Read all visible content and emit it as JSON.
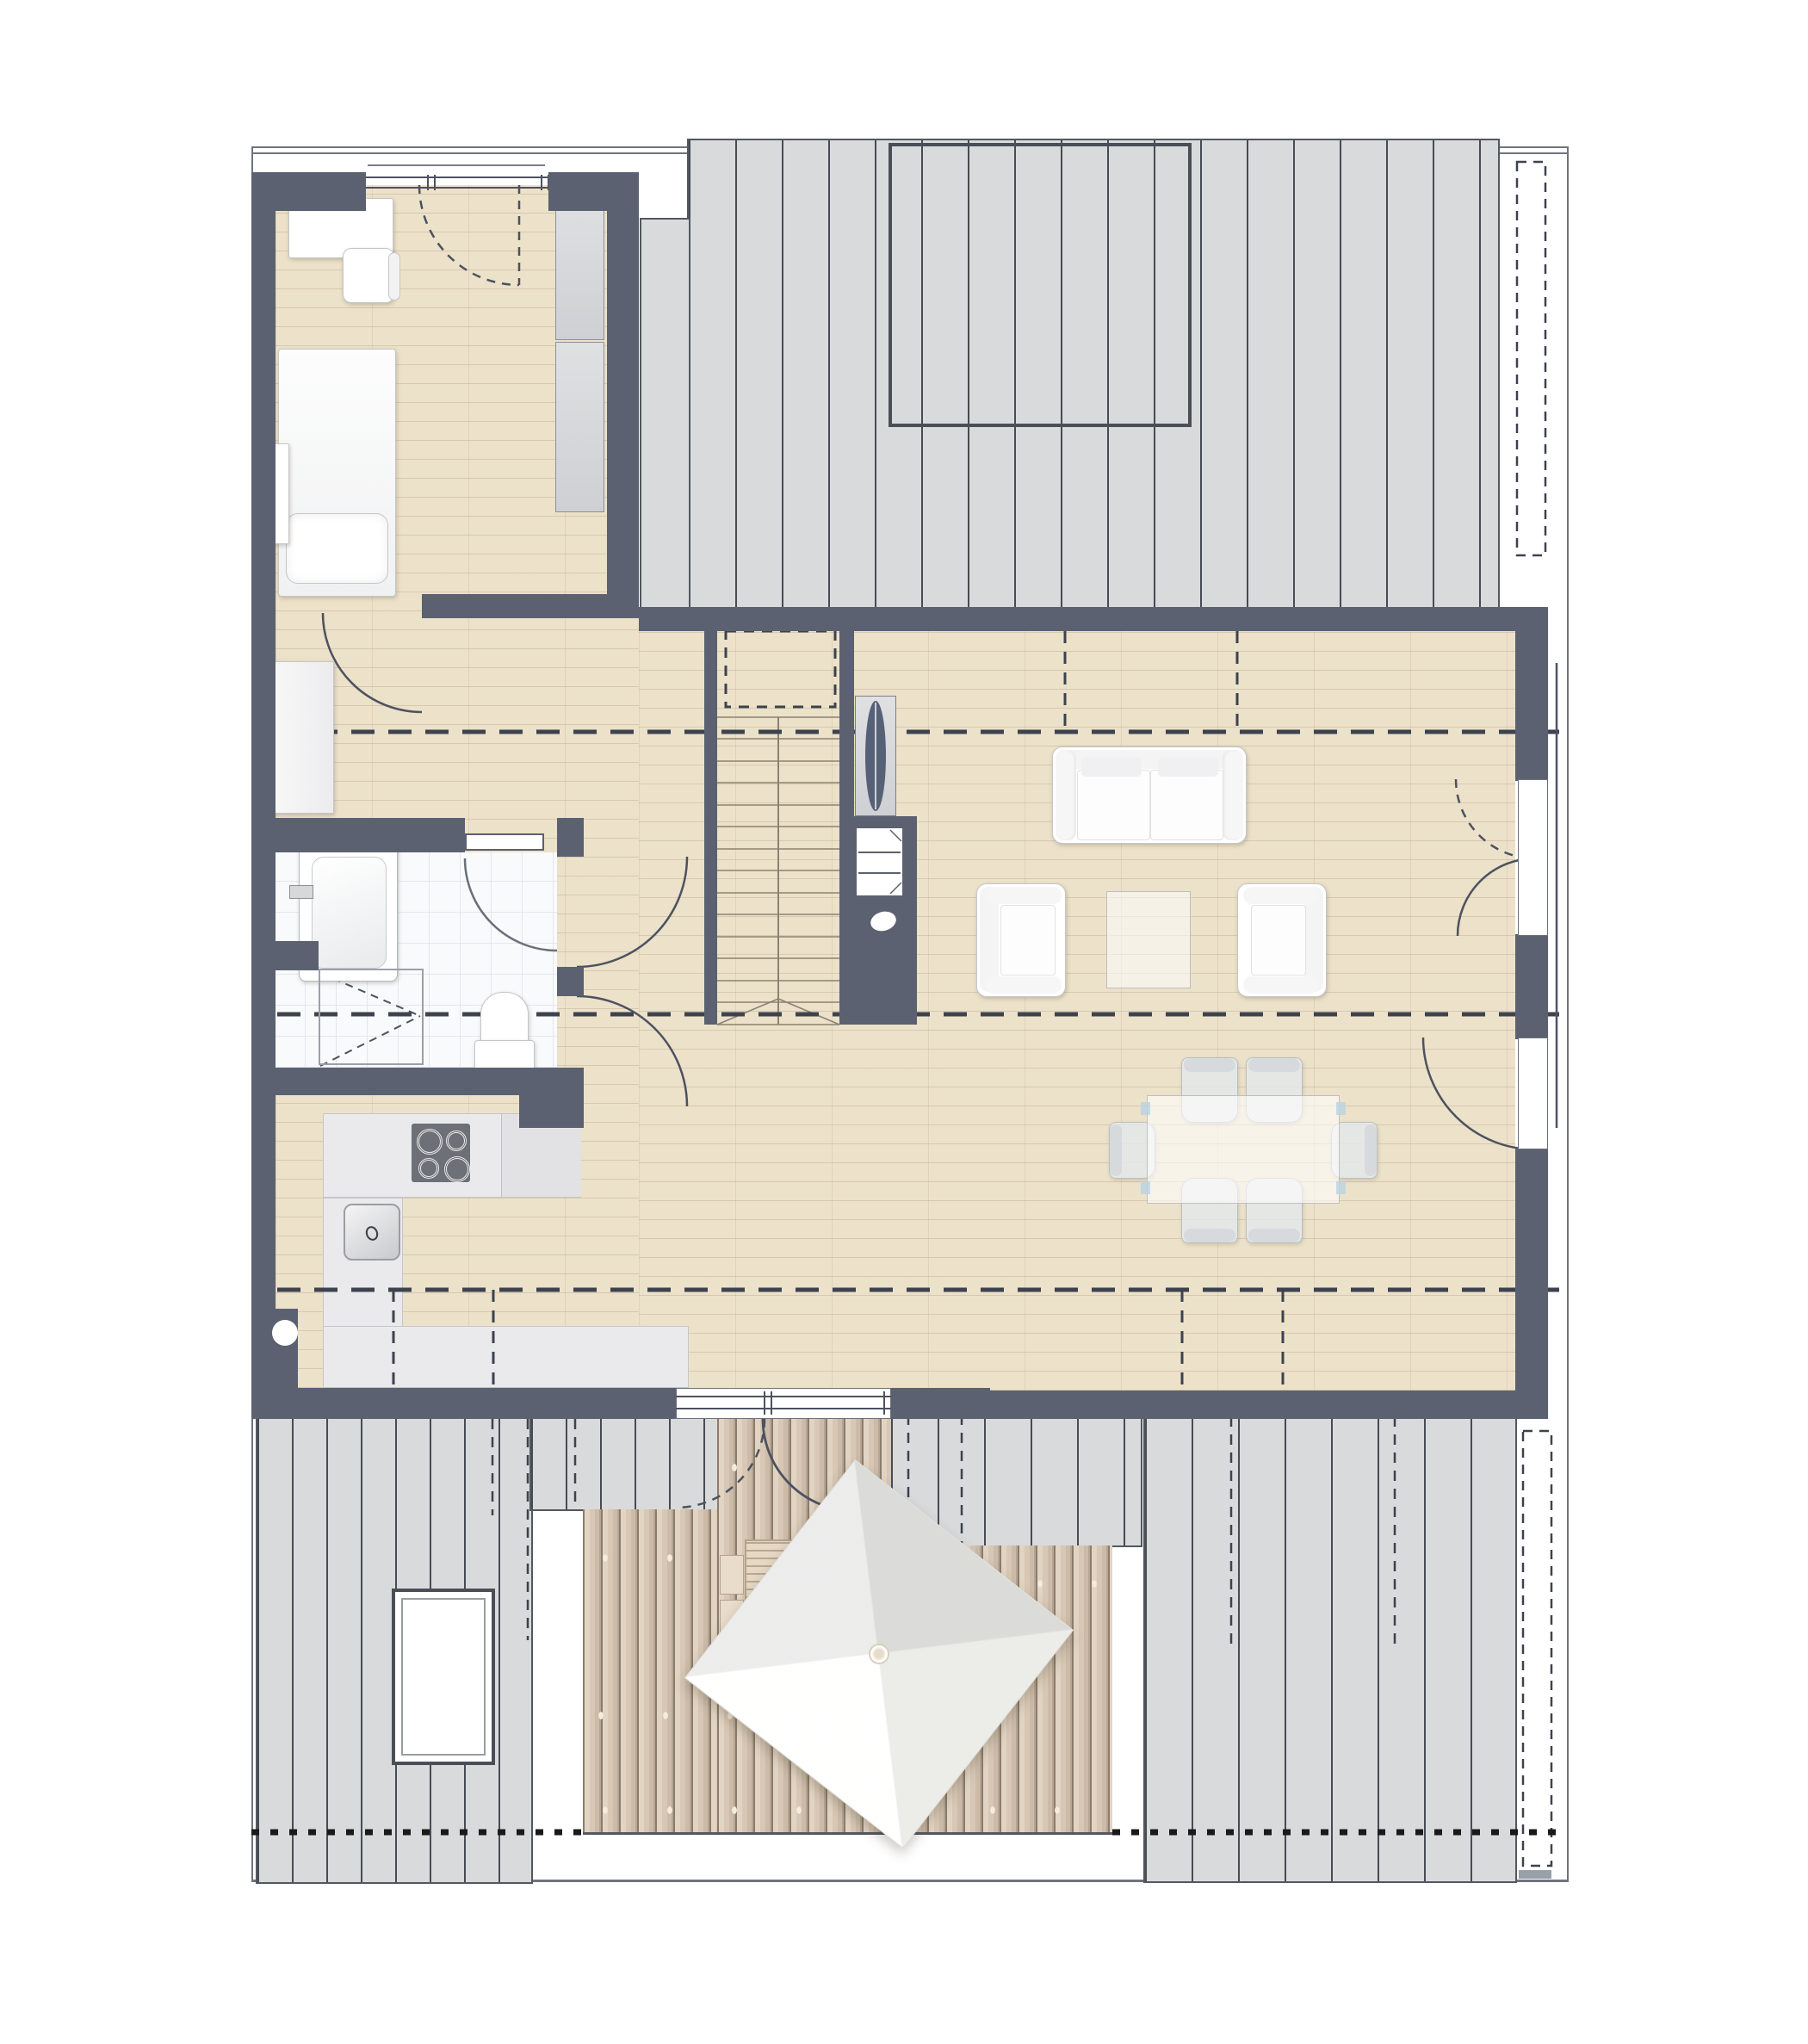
{
  "document": {
    "type": "architectural floor plan (top view)",
    "visible_text": [],
    "scale_labels": []
  },
  "colors": {
    "wall": "#5b6170",
    "wood": "#ece1c9",
    "tile": "#f9fafc",
    "roof": "#d9dadc",
    "deck": "#d8c9b6",
    "outline": "#4b4f58",
    "dash": "#3d424e",
    "boundary": "#1a1a1a",
    "furniture": "#ffffff"
  },
  "rooms": [
    {
      "name": "bedroom",
      "features": [
        "desk",
        "chair",
        "single-bed-with-pillow",
        "wardrobe",
        "small-cabinet",
        "window-door-to-north"
      ]
    },
    {
      "name": "landing-hallway",
      "features": [
        "dresser",
        "two-swing-doors",
        "staircase-opening"
      ]
    },
    {
      "name": "bathroom",
      "features": [
        "bathtub",
        "toilet",
        "shower",
        "mirror-shelf",
        "tiled-floor",
        "swing-door"
      ]
    },
    {
      "name": "kitchen",
      "features": [
        "l-shaped-counter",
        "cooktop-4-burners",
        "sink",
        "column-dot"
      ]
    },
    {
      "name": "living-dining-room",
      "features": [
        "sofa",
        "two-armchairs",
        "coffee-table",
        "dining-table",
        "six-chairs",
        "fireplace-block",
        "radiator-panel",
        "french-doors-east",
        "door-to-terrace"
      ]
    },
    {
      "name": "staircase",
      "features": [
        "treads",
        "center-line",
        "break-line",
        "dashed-opening-above"
      ]
    },
    {
      "name": "terrace",
      "features": [
        "wood-decking",
        "garden-table",
        "benches",
        "square-parasol",
        "screws"
      ]
    },
    {
      "name": "roof-surfaces",
      "features": [
        "north-roof-with-dormer-outline",
        "south-west-roof-with-skylight",
        "south-east-roof",
        "eaves-bands-with-dashed-gutters"
      ]
    }
  ],
  "site": {
    "boundary_style": "dotted",
    "edge_style": "thin-double-line-top"
  }
}
